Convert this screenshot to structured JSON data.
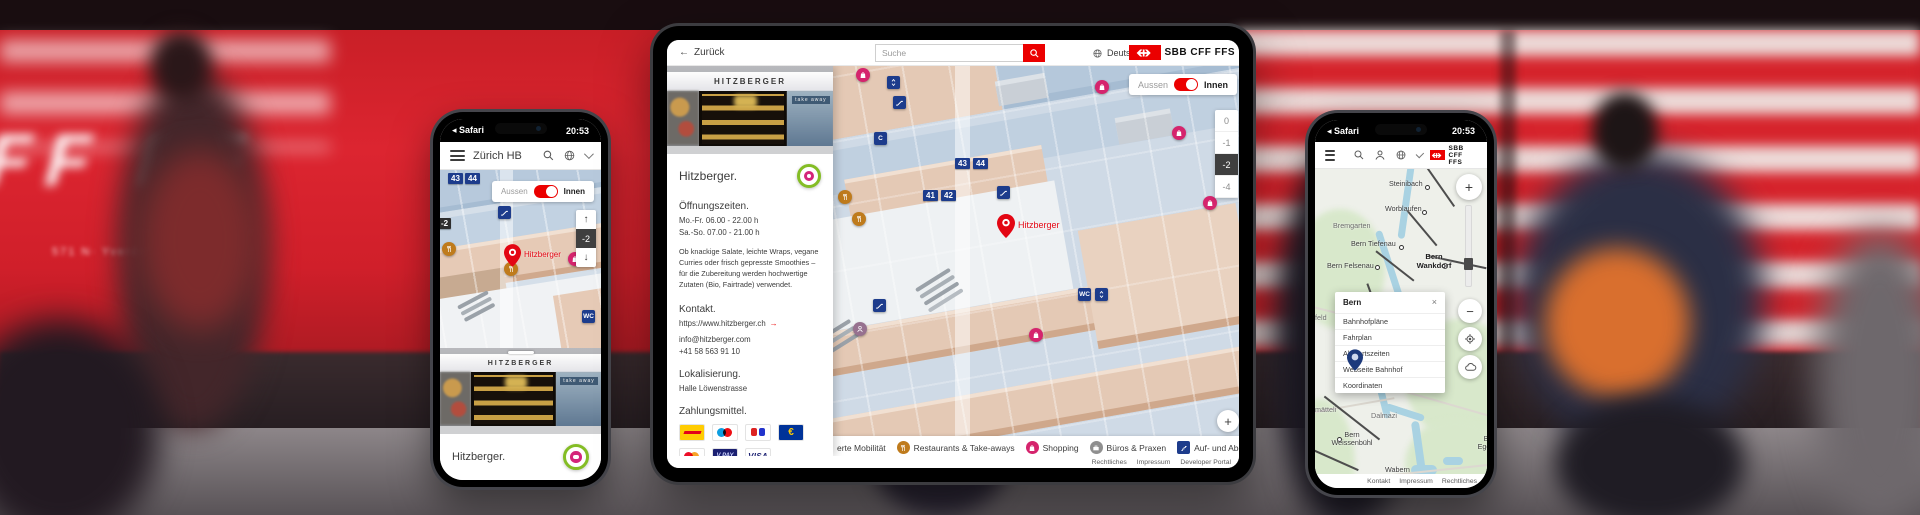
{
  "colors": {
    "sbb_red": "#eb0000",
    "navy_icon": "#1d3c8c",
    "orange_icon": "#bf7b1c",
    "pink_icon": "#d5246d",
    "gray_icon": "#8f8f8f",
    "map_blue": "#cfdae6",
    "map_beige": "#e4c9b5"
  },
  "background": {
    "train_text_large": "FF FF",
    "train_text_small": "571 N· Yverdon   R1 25.02.13"
  },
  "left_phone": {
    "status_bar": {
      "back_glyph": "◂",
      "app": "Safari",
      "time": "20:53"
    },
    "app_bar": {
      "title": "Zürich HB"
    },
    "map": {
      "platform_badges": [
        "43",
        "44"
      ],
      "edge_level_badge": "-2",
      "toggle": {
        "left": "Aussen",
        "right": "Innen"
      },
      "stepper": {
        "up": "↑",
        "level": "-2",
        "down": "↓"
      },
      "wc_label": "WC",
      "pin_label": "Hitzberger"
    },
    "sheet": {
      "shop_sign": "HITZBERGER",
      "takeaway_sign": "take away",
      "title": "Hitzberger."
    }
  },
  "tablet": {
    "header": {
      "back_arrow": "←",
      "back": "Zurück",
      "search_placeholder": "Suche",
      "language": "Deutsch",
      "logo": "SBB CFF FFS"
    },
    "panel": {
      "shop_sign": "HITZBERGER",
      "takeaway_sign": "take away",
      "title": "Hitzberger.",
      "hours_heading": "Öffnungszeiten.",
      "hours": [
        "Mo.-Fr. 06.00 - 22.00 h",
        "Sa.-So. 07.00 - 21.00 h"
      ],
      "description": "Ob knackige Salate, leichte Wraps, vegane Curries oder frisch gepresste Smoothies – für die Zubereitung werden hochwertige Zutaten (Bio, Fairtrade) verwendet.",
      "contact_heading": "Kontakt.",
      "website": "https://www.hitzberger.ch",
      "link_arrow": "→",
      "email": "info@hitzberger.com",
      "phone": "+41 58 563 91 10",
      "location_heading": "Lokalisierung.",
      "location": "Halle Löwenstrasse",
      "payment_heading": "Zahlungsmittel.",
      "payment_methods": [
        "PostFinance",
        "Maestro",
        "Reka",
        "Euro",
        "Mastercard",
        "V PAY",
        "VISA"
      ],
      "euro_symbol": "€",
      "vpay_label": "V PAY",
      "visa_label": "VISA"
    },
    "map": {
      "toggle": {
        "left": "Aussen",
        "right": "Innen"
      },
      "floors": [
        "0",
        "-1",
        "-2",
        "-4"
      ],
      "selected_floor": "-2",
      "badge_c": "C",
      "platform_badges_a": [
        "43",
        "44"
      ],
      "platform_badges_b": [
        "41",
        "42"
      ],
      "wc_label": "WC",
      "pin_label": "Hitzberger",
      "zoom_in": "+",
      "zoom_out": "−"
    },
    "filter_bar": {
      "items": [
        "erte Mobilität",
        "Restaurants & Take-aways",
        "Shopping",
        "Büros & Praxen",
        "Auf- und Abgänge"
      ]
    },
    "footer": {
      "copyright": "© OpenStreetMap contributors, © SBB",
      "links": [
        "Rechtliches",
        "Impressum",
        "Developer Portal"
      ]
    }
  },
  "right_phone": {
    "status_bar": {
      "back_glyph": "◂",
      "app": "Safari",
      "time": "20:53"
    },
    "app_bar": {
      "logo": "SBB CFF FFS"
    },
    "map_labels": [
      "Steinibach",
      "Worblaufen",
      "Bremgarten",
      "Bern Tiefenau",
      "Bern Wankdorf",
      "Bern Felsenau",
      "ufeld",
      "Bern",
      "chermätteli",
      "Dalmazi",
      "Bern Weissenbühl",
      "Wabern",
      "Be Egghö",
      "B"
    ],
    "popup": {
      "title": "Bern",
      "close": "×",
      "items": [
        "Bahnhofpläne",
        "Fahrplan",
        "Abfahrtszeiten",
        "Webseite Bahnhof",
        "Koordinaten"
      ]
    },
    "controls": {
      "zoom_in": "+",
      "zoom_out": "−"
    },
    "footer_links": [
      "Kontakt",
      "Impressum",
      "Rechtliches"
    ]
  }
}
